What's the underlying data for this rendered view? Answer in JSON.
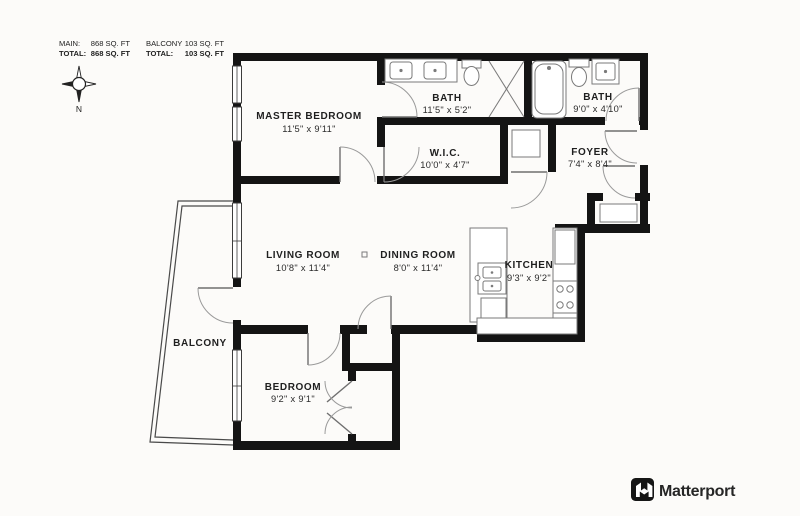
{
  "title": "Apartment Floor Plan",
  "colors": {
    "wall": "#141414",
    "fixture_line": "#7a7a7a",
    "door_arc": "#9a9a9a",
    "text": "#1f1f1f",
    "logo": "#262626"
  },
  "area_table": {
    "row1": {
      "label_a": "MAIN:",
      "value_a": "868 SQ. FT",
      "label_b": "BALCONY",
      "value_b": "103 SQ. FT"
    },
    "row2": {
      "label_a": "TOTAL:",
      "value_a": "868 SQ. FT",
      "label_b": "TOTAL:",
      "value_b": "103 SQ. FT"
    }
  },
  "compass": {
    "north_label": "N"
  },
  "rooms": {
    "master_bedroom": {
      "name": "MASTER BEDROOM",
      "dims": "11'5\" x 9'11\""
    },
    "bath_main": {
      "name": "BATH",
      "dims": "11'5\" x 5'2\""
    },
    "bath_second": {
      "name": "BATH",
      "dims": "9'0\" x 4'10\""
    },
    "wic": {
      "name": "W.I.C.",
      "dims": "10'0\" x 4'7\""
    },
    "foyer": {
      "name": "FOYER",
      "dims": "7'4\" x 8'4\""
    },
    "living_room": {
      "name": "LIVING ROOM",
      "dims": "10'8\" x 11'4\""
    },
    "dining_room": {
      "name": "DINING ROOM",
      "dims": "8'0\" x 11'4\""
    },
    "kitchen": {
      "name": "KITCHEN",
      "dims": "9'3\" x 9'2\""
    },
    "balcony": {
      "name": "BALCONY"
    },
    "bedroom": {
      "name": "BEDROOM",
      "dims": "9'2\" x 9'1\""
    }
  },
  "logo": {
    "text": "Matterport"
  }
}
